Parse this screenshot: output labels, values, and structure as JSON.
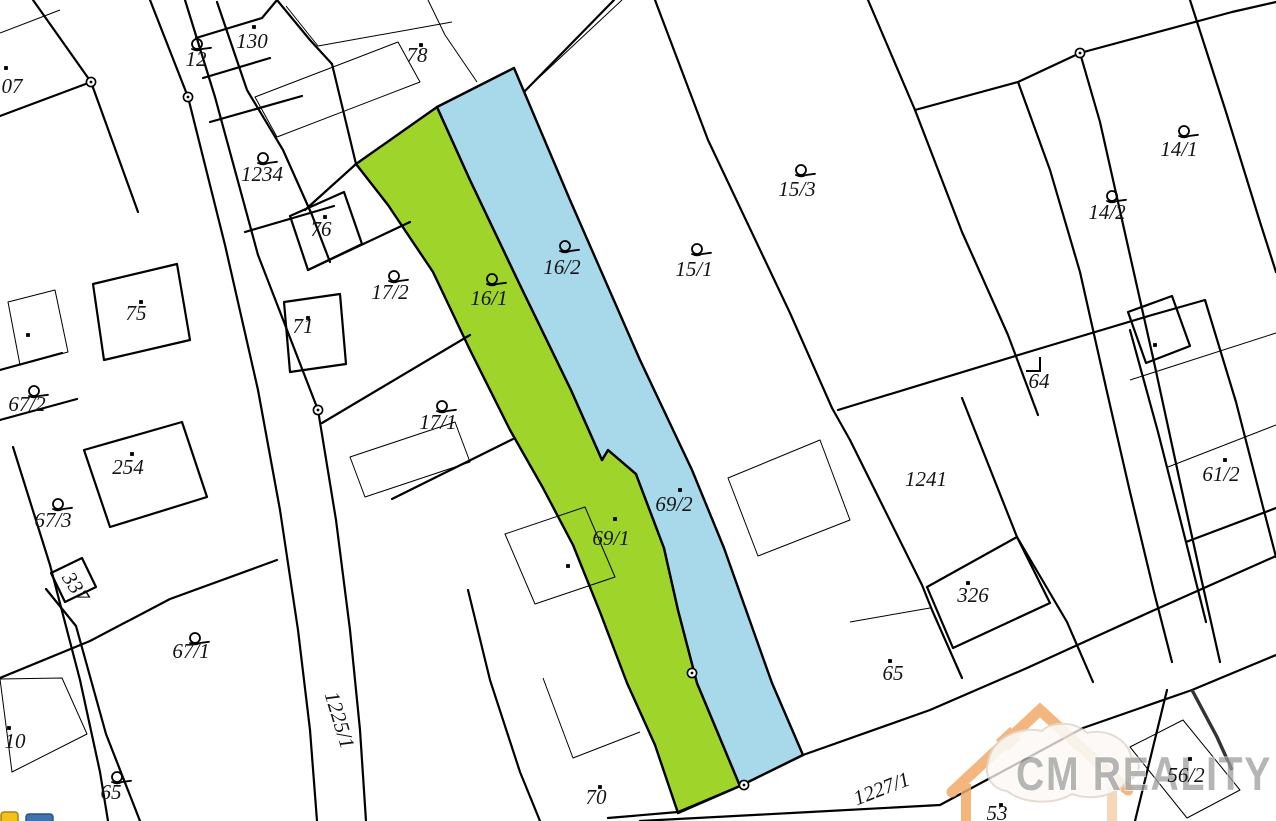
{
  "map": {
    "background": "#ffffff",
    "line_color": "#000000",
    "highlight_green": "#9fd42a",
    "highlight_blue": "#a7d9ea",
    "label_color": "#141414",
    "parcels": [
      {
        "text": "07",
        "x": 12,
        "y": 93,
        "rot": 0,
        "marker": "dot",
        "mx": 6,
        "my": 68
      },
      {
        "text": "12",
        "x": 196,
        "y": 66,
        "rot": 0,
        "marker": "building",
        "mx": 197,
        "my": 44
      },
      {
        "text": "130",
        "x": 252,
        "y": 48,
        "rot": 0,
        "marker": "dot",
        "mx": 254,
        "my": 27
      },
      {
        "text": "78",
        "x": 417,
        "y": 62,
        "rot": 0,
        "marker": "dot",
        "mx": 421,
        "my": 45
      },
      {
        "text": "1234",
        "x": 262,
        "y": 181,
        "rot": 0,
        "marker": "building",
        "mx": 263,
        "my": 158
      },
      {
        "text": "76",
        "x": 321,
        "y": 236,
        "rot": 0,
        "marker": "dot",
        "mx": 325,
        "my": 217
      },
      {
        "text": "17/2",
        "x": 390,
        "y": 299,
        "rot": 0,
        "marker": "building",
        "mx": 394,
        "my": 276
      },
      {
        "text": "71",
        "x": 303,
        "y": 333,
        "rot": 0,
        "marker": "dot",
        "mx": 308,
        "my": 318
      },
      {
        "text": "16/1",
        "x": 489,
        "y": 305,
        "rot": 0,
        "marker": "building",
        "mx": 492,
        "my": 279
      },
      {
        "text": "16/2",
        "x": 562,
        "y": 274,
        "rot": 0,
        "marker": "building",
        "mx": 565,
        "my": 246
      },
      {
        "text": "15/1",
        "x": 694,
        "y": 276,
        "rot": 0,
        "marker": "building",
        "mx": 697,
        "my": 249
      },
      {
        "text": "15/3",
        "x": 797,
        "y": 196,
        "rot": 0,
        "marker": "building",
        "mx": 801,
        "my": 170
      },
      {
        "text": "14/1",
        "x": 1179,
        "y": 156,
        "rot": 0,
        "marker": "building",
        "mx": 1184,
        "my": 131
      },
      {
        "text": "14/2",
        "x": 1107,
        "y": 219,
        "rot": 0,
        "marker": "building",
        "mx": 1112,
        "my": 196
      },
      {
        "text": "64",
        "x": 1039,
        "y": 388,
        "rot": 0,
        "marker": "corner",
        "mx": 1033,
        "my": 362
      },
      {
        "text": "75",
        "x": 136,
        "y": 320,
        "rot": 0,
        "marker": "dot",
        "mx": 141,
        "my": 302
      },
      {
        "text": "67/2",
        "x": 27,
        "y": 411,
        "rot": 0,
        "marker": "building",
        "mx": 34,
        "my": 391
      },
      {
        "text": "254",
        "x": 128,
        "y": 474,
        "rot": 0,
        "marker": "dot",
        "mx": 132,
        "my": 454
      },
      {
        "text": "17/1",
        "x": 438,
        "y": 429,
        "rot": 0,
        "marker": "building",
        "mx": 442,
        "my": 406
      },
      {
        "text": "67/3",
        "x": 53,
        "y": 527,
        "rot": 0,
        "marker": "building",
        "mx": 58,
        "my": 504
      },
      {
        "text": "337",
        "x": 70,
        "y": 591,
        "rot": 57,
        "marker": "none"
      },
      {
        "text": "1241",
        "x": 926,
        "y": 486,
        "rot": 0,
        "marker": "none"
      },
      {
        "text": "69/2",
        "x": 674,
        "y": 511,
        "rot": 0,
        "marker": "dot",
        "mx": 680,
        "my": 490
      },
      {
        "text": "69/1",
        "x": 611,
        "y": 545,
        "rot": 0,
        "marker": "dot",
        "mx": 615,
        "my": 519
      },
      {
        "text": "326",
        "x": 973,
        "y": 602,
        "rot": 0,
        "marker": "dot",
        "mx": 968,
        "my": 583
      },
      {
        "text": "61/2",
        "x": 1221,
        "y": 481,
        "rot": 0,
        "marker": "dot",
        "mx": 1225,
        "my": 460
      },
      {
        "text": "65",
        "x": 893,
        "y": 680,
        "rot": 0,
        "marker": "dot",
        "mx": 890,
        "my": 661
      },
      {
        "text": "67/1",
        "x": 191,
        "y": 658,
        "rot": 0,
        "marker": "building",
        "mx": 195,
        "my": 638
      },
      {
        "text": "10",
        "x": 15,
        "y": 748,
        "rot": 0,
        "marker": "dot",
        "mx": 9,
        "my": 728
      },
      {
        "text": "65",
        "x": 111,
        "y": 799,
        "rot": 0,
        "marker": "building",
        "mx": 117,
        "my": 777
      },
      {
        "text": "1225/1",
        "x": 333,
        "y": 722,
        "rot": 73,
        "marker": "none"
      },
      {
        "text": "70",
        "x": 596,
        "y": 804,
        "rot": 0,
        "marker": "dot",
        "mx": 600,
        "my": 787
      },
      {
        "text": "1227/1",
        "x": 884,
        "y": 795,
        "rot": -21,
        "marker": "none"
      },
      {
        "text": "56/2",
        "x": 1186,
        "y": 782,
        "rot": 0,
        "marker": "dot",
        "mx": 1190,
        "my": 759
      },
      {
        "text": "53",
        "x": 997,
        "y": 820,
        "rot": 0,
        "marker": "dot",
        "mx": 1001,
        "my": 805
      }
    ],
    "lone_dots": [
      {
        "x": 1155,
        "y": 345
      },
      {
        "x": 568,
        "y": 566
      },
      {
        "x": 28,
        "y": 335
      }
    ],
    "survey_points": [
      {
        "x": 91,
        "y": 82
      },
      {
        "x": 188,
        "y": 97
      },
      {
        "x": 318,
        "y": 410
      },
      {
        "x": 1080,
        "y": 53
      },
      {
        "x": 692,
        "y": 673
      },
      {
        "x": 744,
        "y": 785
      }
    ],
    "watermark": {
      "text": "CM REALITY",
      "house_color": "#f0aa68",
      "text_color": "#9c9c9c"
    },
    "corner_badges": [
      {
        "name": "yellow-badge",
        "color": "#f3c01c"
      },
      {
        "name": "blue-badge",
        "color": "#4272ae"
      }
    ]
  }
}
